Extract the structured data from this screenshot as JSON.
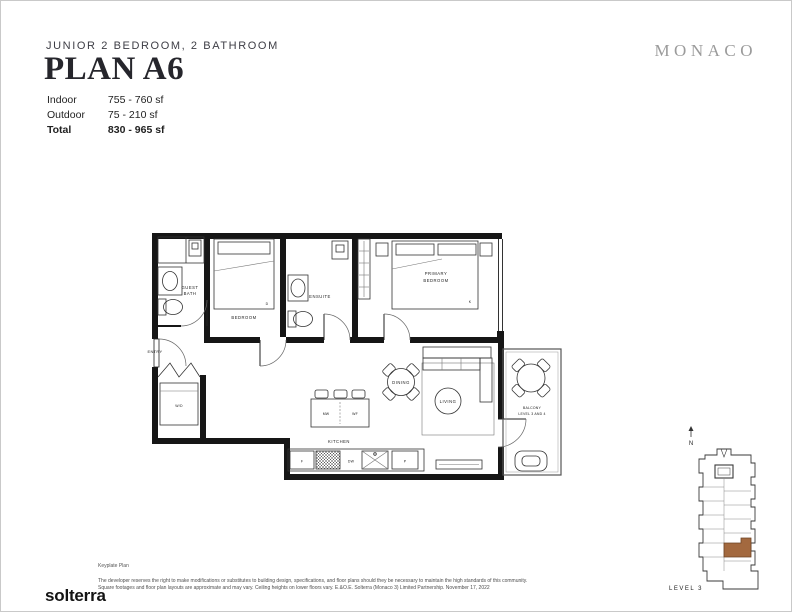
{
  "header": {
    "subtitle": "JUNIOR 2 BEDROOM, 2 BATHROOM",
    "title": "PLAN A6",
    "brand": "MONACO",
    "stats": [
      {
        "label": "Indoor",
        "value": "755 - 760 sf"
      },
      {
        "label": "Outdoor",
        "value": "75 - 210 sf"
      },
      {
        "label": "Total",
        "value": "830 - 965 sf"
      }
    ]
  },
  "plan": {
    "labels": {
      "entry": "ENTRY",
      "guest_bath_line1": "GUEST",
      "guest_bath_line2": "BATH",
      "bedroom": "BEDROOM",
      "ensuite": "ENSUITE",
      "primary_line1": "PRIMARY",
      "primary_line2": "BEDROOM",
      "wd": "W/D",
      "kitchen": "KITCHEN",
      "dining": "DINING",
      "living": "LIVING",
      "balcony_line1": "BALCONY",
      "balcony_line2": "LEVEL 3 AND 4"
    },
    "appliances": {
      "microwave": "MW",
      "wine_fridge": "WF",
      "dishwasher": "DW",
      "fridge": "F",
      "pantry": "P"
    },
    "bed_markers": {
      "bedroom": "D",
      "primary": "K"
    }
  },
  "keyplate": {
    "north_label": "N",
    "level_label": "LEVEL 3",
    "highlight_color": "#a3693f"
  },
  "footer": {
    "logo": "solterra",
    "keyplate_caption": "Keyplate Plan",
    "disclaimer_line1": "The developer reserves the right to make modifications or substitutes to building design, specifications, and floor plans should they be necessary to maintain the high standards of this community.",
    "disclaimer_line2": "Square footages and floor plan layouts are approximate and may vary. Ceiling heights on lower floors vary. E.&O.E. Solterra (Monaco 3) Limited Partnership. November 17, 2022"
  }
}
